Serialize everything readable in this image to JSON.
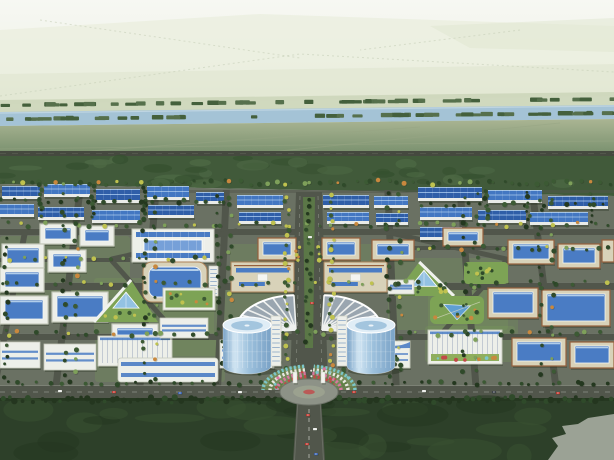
{
  "canvas": {
    "width": 614,
    "height": 460
  },
  "palette": {
    "skyTop": "#f7f8f3",
    "skyMid": "#eef1e6",
    "skyLow": "#e3e9d6",
    "distantA": "#e9eedd",
    "distantB": "#dfe6cf",
    "distantDot": "#c2ccb4",
    "farBand": "#cbd5b8",
    "river": "#a4c3d6",
    "riverLight": "#c6dae6",
    "bankTree": "#56704c",
    "bankTreeDark": "#44603c",
    "fieldTop": "#aab593",
    "fieldBottom": "#7d9371",
    "fieldPath": "#97a584",
    "highway": "#45493f",
    "highwayLine": "#61655a",
    "belt": "#415a3a",
    "beltDark": "#35502f",
    "beltLight": "#4e6a45",
    "parkBase": "#6a7163",
    "road": "#51564b",
    "roadLight": "#70756a",
    "curb": "#878c80",
    "roofBlue": "#2f5ea8",
    "roofBlueLight": "#4377c2",
    "roofRidge": "#8fb4e2",
    "wall": "#e9ebe8",
    "shadow": "#1e2818",
    "beige": "#d8d2b9",
    "beigeTrim": "#ab8259",
    "brownRim": "#96603c",
    "white": "#edefe9",
    "whiteTrim": "#c6cabc",
    "glass": "#4a7cc4",
    "glassLight": "#76a0d8",
    "glassPale": "#bcd6ee",
    "lawn": "#7da355",
    "lawnDark": "#5f8a44",
    "treeDark": "#2f4a2a",
    "treeMid": "#3c5a34",
    "treeLight": "#7ea05a",
    "treeYellow": "#bfc24f",
    "treeOrange": "#c9883e",
    "towerGlassTop": "#e0edf6",
    "towerGlassHi": "#cfe4f2",
    "towerGlassMid": "#9cc0dc",
    "towerGlassLo": "#7aa2c6",
    "fanBase": "#9aa6b0",
    "fanRib": "#eef0ee",
    "plaza": "#8d9287",
    "plazaInner": "#9ba18f",
    "flowerTeal": "#7cc6ca",
    "flowerWhite": "#e9e7e1",
    "flowerPink": "#d876a0",
    "flowerRed": "#c24848",
    "forest": "#2d4029",
    "forestDark": "#24361f",
    "forestLight": "#3a5232",
    "clearing": "#9ba295",
    "carRed": "#c23a32",
    "carWhite": "#e8eae6",
    "carBlue": "#3a62b0",
    "carDark": "#3a4048",
    "pond": "#5f9fd2",
    "pyramid": "#93c2e2",
    "median": "#5b7747"
  },
  "scene": {
    "sky": {
      "y": 0,
      "h": 132
    },
    "distantPolys": [
      {
        "points": "0,30 260,14 614,26 614,64 0,74",
        "fill": "distantA",
        "opacity": 0.7
      },
      {
        "points": "0,74 614,64 614,96 0,104",
        "fill": "distantB",
        "opacity": 0.7
      },
      {
        "points": "430,26 614,18 614,52 470,48",
        "fill": "distantB",
        "opacity": 0.5
      }
    ],
    "distantDotLines": [
      "M0,96 L300,54 L614,72",
      "M40,20 L300,58 M520,30 L360,50"
    ],
    "farBand": "0,100 614,92 614,108 0,114",
    "river": {
      "poly": "0,112 614,105 614,119 0,126",
      "hiFrom": [
        0,
        113
      ],
      "hiTo": [
        614,
        106
      ]
    },
    "riverTreeRows": [
      [
        107,
        101,
        46,
        614
      ],
      [
        121,
        115,
        52,
        614
      ],
      [
        130,
        127,
        16,
        220
      ]
    ],
    "field": {
      "poly": "0,126 614,119 614,151 0,151"
    },
    "fieldPaths": [
      [
        0,
        149,
        614,
        141
      ],
      [
        90,
        151,
        420,
        127
      ],
      [
        280,
        151,
        560,
        123
      ]
    ],
    "highway": {
      "y": 151,
      "h": 5
    },
    "belt": {
      "poly": "0,156 614,156 614,196 0,184",
      "blobs": 34
    },
    "park": {
      "poly": "0,184 614,196 614,386 0,386"
    },
    "lawnPatches": [
      [
        0,
        236,
        130,
        62
      ],
      [
        94,
        278,
        120,
        58
      ],
      [
        160,
        286,
        120,
        70
      ],
      [
        388,
        258,
        120,
        72
      ],
      [
        428,
        290,
        90,
        50
      ],
      [
        230,
        244,
        160,
        40
      ],
      [
        95,
        334,
        130,
        48
      ],
      [
        425,
        326,
        90,
        36
      ]
    ],
    "roads": {
      "horizontal": [
        [
          0,
          190,
          614,
          3,
          0.5
        ],
        [
          0,
          229,
          614,
          6,
          1
        ],
        [
          410,
          246,
          204,
          4,
          1
        ],
        [
          0,
          258,
          130,
          4,
          1
        ],
        [
          0,
          283,
          614,
          7,
          1
        ],
        [
          0,
          334,
          614,
          6,
          1
        ]
      ],
      "vertical": [
        [
          10,
          232,
          6
        ],
        [
          68,
          190,
          7
        ],
        [
          148,
          190,
          7
        ],
        [
          222,
          190,
          7
        ],
        [
          392,
          190,
          7
        ],
        [
          468,
          190,
          7
        ],
        [
          544,
          190,
          7
        ]
      ],
      "diagonals": [
        [
          112,
          261,
          176,
          333
        ],
        [
          112,
          259,
          236,
          231
        ],
        [
          506,
          261,
          442,
          333
        ],
        [
          506,
          259,
          382,
          231
        ]
      ],
      "boulevard": {
        "poly": "296,192 322,192 328,386 290,386",
        "median": "303,197 315,197 313,348 305,348"
      },
      "front": {
        "y": 386,
        "h": 12
      }
    },
    "buildings": [
      [
        "fac",
        2,
        186,
        38,
        13,
        0
      ],
      [
        "fac",
        44,
        184,
        46,
        13,
        1
      ],
      [
        "fac",
        96,
        189,
        44,
        14,
        0
      ],
      [
        "fac",
        147,
        186,
        42,
        14,
        1
      ],
      [
        "fac",
        0,
        204,
        34,
        13,
        1
      ],
      [
        "fac",
        38,
        207,
        46,
        13,
        0
      ],
      [
        "fac",
        92,
        210,
        48,
        13,
        1
      ],
      [
        "fac",
        148,
        205,
        46,
        13,
        0
      ],
      [
        "fac",
        196,
        192,
        28,
        12,
        0
      ],
      [
        "fac",
        237,
        195,
        46,
        13,
        1
      ],
      [
        "fac",
        239,
        212,
        42,
        12,
        0
      ],
      [
        "fac",
        323,
        195,
        46,
        13,
        0
      ],
      [
        "fac",
        327,
        212,
        42,
        12,
        1
      ],
      [
        "fac",
        374,
        196,
        34,
        12,
        1
      ],
      [
        "fac",
        376,
        213,
        32,
        12,
        0
      ],
      [
        "fac",
        418,
        187,
        64,
        14,
        0
      ],
      [
        "fac",
        488,
        190,
        54,
        13,
        1
      ],
      [
        "fac",
        548,
        196,
        60,
        13,
        0
      ],
      [
        "fac",
        420,
        207,
        52,
        13,
        1
      ],
      [
        "fac",
        478,
        210,
        48,
        13,
        0
      ],
      [
        "fac",
        530,
        212,
        58,
        13,
        1
      ],
      [
        "fac",
        420,
        227,
        42,
        13,
        0
      ],
      [
        "wcourt",
        40,
        224,
        36,
        20,
        0
      ],
      [
        "wcourt",
        80,
        226,
        34,
        20,
        0
      ],
      [
        "bigwhite",
        132,
        229,
        82,
        33,
        0
      ],
      [
        "wcourt",
        2,
        244,
        42,
        24,
        0
      ],
      [
        "wcourt",
        48,
        250,
        38,
        22,
        0
      ],
      [
        "court",
        258,
        238,
        38,
        22,
        0
      ],
      [
        "court",
        322,
        238,
        38,
        22,
        0
      ],
      [
        "court",
        372,
        240,
        42,
        20,
        0
      ],
      [
        "court",
        443,
        228,
        40,
        18,
        0
      ],
      [
        "court",
        508,
        240,
        46,
        24,
        0
      ],
      [
        "court",
        558,
        244,
        42,
        24,
        0
      ],
      [
        "court",
        602,
        240,
        12,
        22,
        0
      ],
      [
        "green",
        464,
        262,
        44,
        22,
        0
      ],
      [
        "tri",
        394,
        262,
        60,
        34,
        1
      ],
      [
        "slab",
        388,
        280,
        26,
        14,
        0
      ],
      [
        "wcourt",
        0,
        268,
        44,
        24,
        0
      ],
      [
        "curve",
        143,
        262,
        64,
        40,
        0
      ],
      [
        "tower",
        209,
        266,
        9,
        30,
        0
      ],
      [
        "hall",
        231,
        262,
        63,
        30,
        0
      ],
      [
        "hall",
        324,
        262,
        63,
        30,
        0
      ],
      [
        "wcourt",
        0,
        296,
        48,
        28,
        0
      ],
      [
        "wcourt",
        52,
        292,
        56,
        30,
        0
      ],
      [
        "tri",
        94,
        280,
        64,
        42,
        0
      ],
      [
        "greenroof",
        163,
        288,
        52,
        22,
        0
      ],
      [
        "wcourt",
        112,
        324,
        46,
        16,
        0
      ],
      [
        "pond",
        430,
        296,
        54,
        28,
        0
      ],
      [
        "court",
        488,
        288,
        50,
        30,
        0
      ],
      [
        "court",
        542,
        290,
        68,
        36,
        0
      ],
      [
        "slab",
        0,
        342,
        40,
        26,
        0
      ],
      [
        "slab",
        44,
        344,
        52,
        26,
        0
      ],
      [
        "saw",
        98,
        336,
        74,
        30,
        0
      ],
      [
        "slab",
        160,
        318,
        48,
        20,
        0
      ],
      [
        "slabLong",
        118,
        358,
        100,
        24,
        0
      ],
      [
        "slab",
        220,
        340,
        54,
        28,
        0
      ],
      [
        "wavy",
        352,
        338,
        58,
        30,
        0
      ],
      [
        "sawGarden",
        428,
        330,
        74,
        34,
        0
      ],
      [
        "court",
        512,
        338,
        54,
        28,
        0
      ],
      [
        "court",
        570,
        342,
        44,
        26,
        0
      ],
      [
        "fan",
        296,
        330,
        60,
        58,
        -1
      ],
      [
        "fan",
        322,
        330,
        60,
        58,
        1
      ]
    ],
    "treeStrips": [
      [
        0,
        180,
        614,
        5,
        70,
        "mix"
      ],
      [
        0,
        199,
        228,
        4,
        20,
        "dark"
      ],
      [
        412,
        202,
        200,
        4,
        16,
        "dark"
      ],
      [
        0,
        222,
        614,
        5,
        45,
        "mix"
      ],
      [
        410,
        246,
        204,
        4,
        18,
        "mix"
      ],
      [
        0,
        257,
        230,
        4,
        16,
        "mix"
      ],
      [
        0,
        281,
        614,
        5,
        40,
        "mix"
      ],
      [
        0,
        331,
        614,
        5,
        40,
        "mix"
      ],
      [
        0,
        381,
        614,
        4,
        55,
        "dark"
      ],
      [
        284,
        194,
        5,
        176,
        26,
        "ymix"
      ],
      [
        329,
        194,
        5,
        176,
        26,
        "ymix"
      ],
      [
        305,
        197,
        7,
        148,
        20,
        "dark"
      ],
      [
        4,
        232,
        4,
        150,
        14,
        "dark"
      ],
      [
        62,
        192,
        4,
        190,
        16,
        "dark"
      ],
      [
        74,
        192,
        4,
        190,
        14,
        "mix"
      ],
      [
        142,
        192,
        4,
        190,
        16,
        "dark"
      ],
      [
        154,
        192,
        4,
        190,
        14,
        "mix"
      ],
      [
        216,
        192,
        4,
        140,
        14,
        "dark"
      ],
      [
        228,
        192,
        4,
        140,
        12,
        "mix"
      ],
      [
        386,
        192,
        4,
        190,
        16,
        "dark"
      ],
      [
        398,
        192,
        4,
        190,
        14,
        "mix"
      ],
      [
        462,
        192,
        4,
        190,
        14,
        "dark"
      ],
      [
        474,
        192,
        4,
        190,
        12,
        "mix"
      ],
      [
        538,
        192,
        4,
        190,
        14,
        "dark"
      ],
      [
        550,
        192,
        4,
        190,
        12,
        "mix"
      ],
      [
        39,
        184,
        4,
        34,
        8,
        "dark"
      ],
      [
        91,
        186,
        4,
        34,
        8,
        "dark"
      ],
      [
        143,
        186,
        4,
        34,
        8,
        "dark"
      ],
      [
        484,
        188,
        4,
        40,
        8,
        "dark"
      ],
      [
        526,
        192,
        4,
        36,
        8,
        "dark"
      ],
      [
        590,
        192,
        4,
        34,
        6,
        "dark"
      ],
      [
        258,
        350,
        26,
        26,
        10,
        "dark"
      ],
      [
        332,
        350,
        26,
        26,
        10,
        "dark"
      ],
      [
        222,
        334,
        8,
        34,
        7,
        "dark"
      ],
      [
        390,
        334,
        8,
        34,
        7,
        "dark"
      ],
      [
        294,
        246,
        6,
        16,
        5,
        "ymix"
      ],
      [
        316,
        246,
        6,
        16,
        5,
        "ymix"
      ]
    ],
    "center": {
      "towers": [
        {
          "cx": 247
        },
        {
          "cx": 371
        }
      ],
      "towerGeom": {
        "top": 322,
        "bottom": 366,
        "rx": 24,
        "ryTop": 8
      },
      "cores": [
        [
          271,
          316,
          10,
          50
        ],
        [
          337,
          316,
          10,
          50
        ]
      ],
      "plaza": {
        "cx": 309,
        "cy": 392,
        "rx": 29,
        "ry": 13
      },
      "flowers": {
        "cx": 309,
        "cy": 390,
        "radii": [
          46,
          39,
          32,
          26
        ],
        "ryf": 0.52,
        "colors": [
          "flowerTeal",
          "flowerWhite",
          "flowerPink",
          "flowerRed"
        ],
        "leftAngles": [
          96,
          180
        ],
        "rightAngles": [
          0,
          84
        ]
      },
      "gates": [
        [
          293,
          372,
          4,
          11
        ],
        [
          321,
          372,
          4,
          11
        ]
      ]
    },
    "forest": {
      "y": 398,
      "h": 62,
      "blobs": 28,
      "edgeTrees": 95
    },
    "clearing": "548,460 558,446 552,438 566,434 562,426 578,424 588,418 614,414 614,460",
    "accessRoad": {
      "poly": "297,398 321,398 325,460 293,460",
      "dashX": 309
    },
    "cars": [
      [
        58,
        390,
        "carWhite"
      ],
      [
        112,
        391,
        "carRed"
      ],
      [
        178,
        392,
        "carBlue"
      ],
      [
        238,
        391,
        "carWhite"
      ],
      [
        352,
        391,
        "carRed"
      ],
      [
        422,
        390,
        "carWhite"
      ],
      [
        492,
        391,
        "carDark"
      ],
      [
        556,
        392,
        "carRed"
      ],
      [
        306,
        414,
        "carRed"
      ],
      [
        313,
        428,
        "carWhite"
      ],
      [
        305,
        443,
        "carRed"
      ],
      [
        314,
        453,
        "carBlue"
      ],
      [
        308,
        236,
        "carWhite"
      ],
      [
        310,
        302,
        "carRed"
      ]
    ]
  }
}
